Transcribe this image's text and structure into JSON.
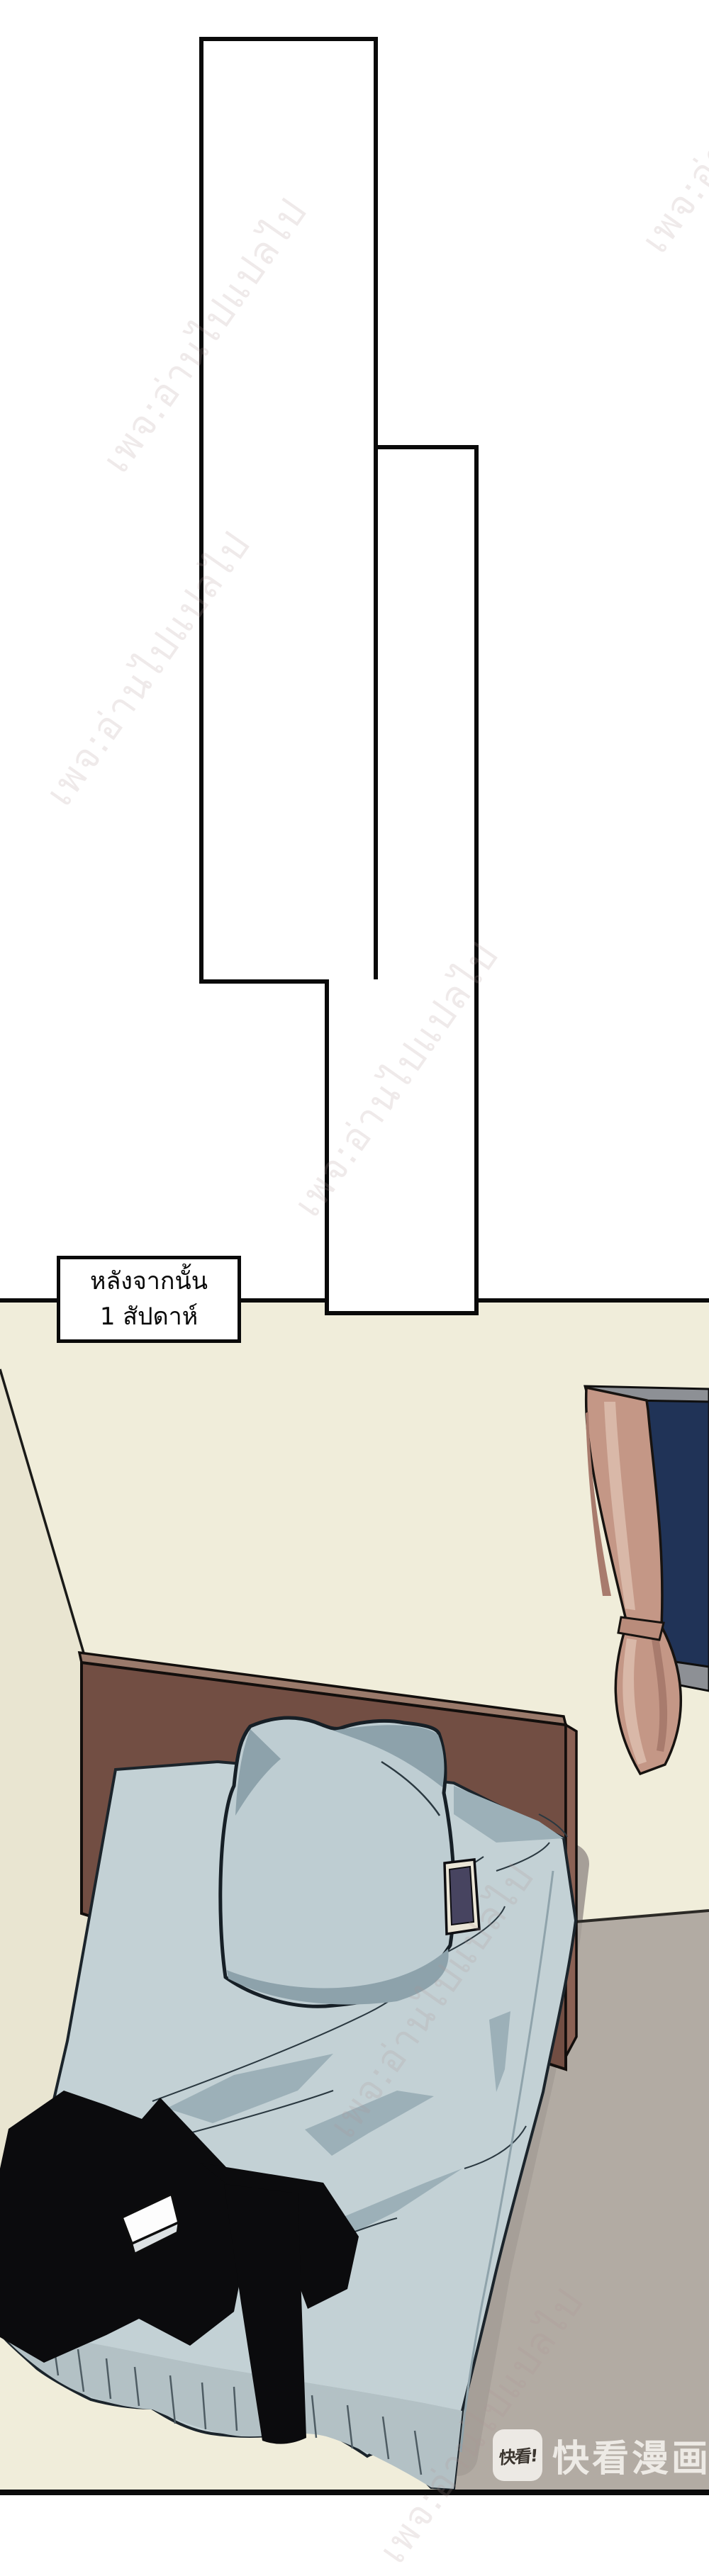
{
  "caption": {
    "line1": "หลังจากนั้น",
    "line2": "1 สัปดาห์"
  },
  "watermark": {
    "text": "เพจ:อ่านไปแปลไป"
  },
  "logo": {
    "icon_text": "快看!",
    "brand_text": "快看漫画"
  },
  "colors": {
    "page_background": "#ffffff",
    "panel_border": "#0a0a0a",
    "wall": "#f0edda",
    "wall_shaded": "#e9e5d1",
    "floor": "#b2aba3",
    "floor_shadow": "#a69f98",
    "window_frame": "#8d9095",
    "window_glass": "#203357",
    "curtain": "#c49786",
    "curtain_light": "#d9b8a8",
    "curtain_dark": "#a87b6d",
    "headboard_front": "#724e43",
    "headboard_side": "#8a6154",
    "headboard_top": "#9a7a6b",
    "sheet": "#c3d1d5",
    "sheet_shadow": "#9cb0b8",
    "drape": "#b3c1c5",
    "pillow": "#becdd2",
    "pillow_shadow": "#8da2ab",
    "phone_frame": "#eae5d6",
    "phone_screen": "#474460",
    "clothes": "#0b0b0d",
    "card": "#fdfdfd",
    "card_side": "#dde2e4",
    "outline": "#10151a"
  }
}
